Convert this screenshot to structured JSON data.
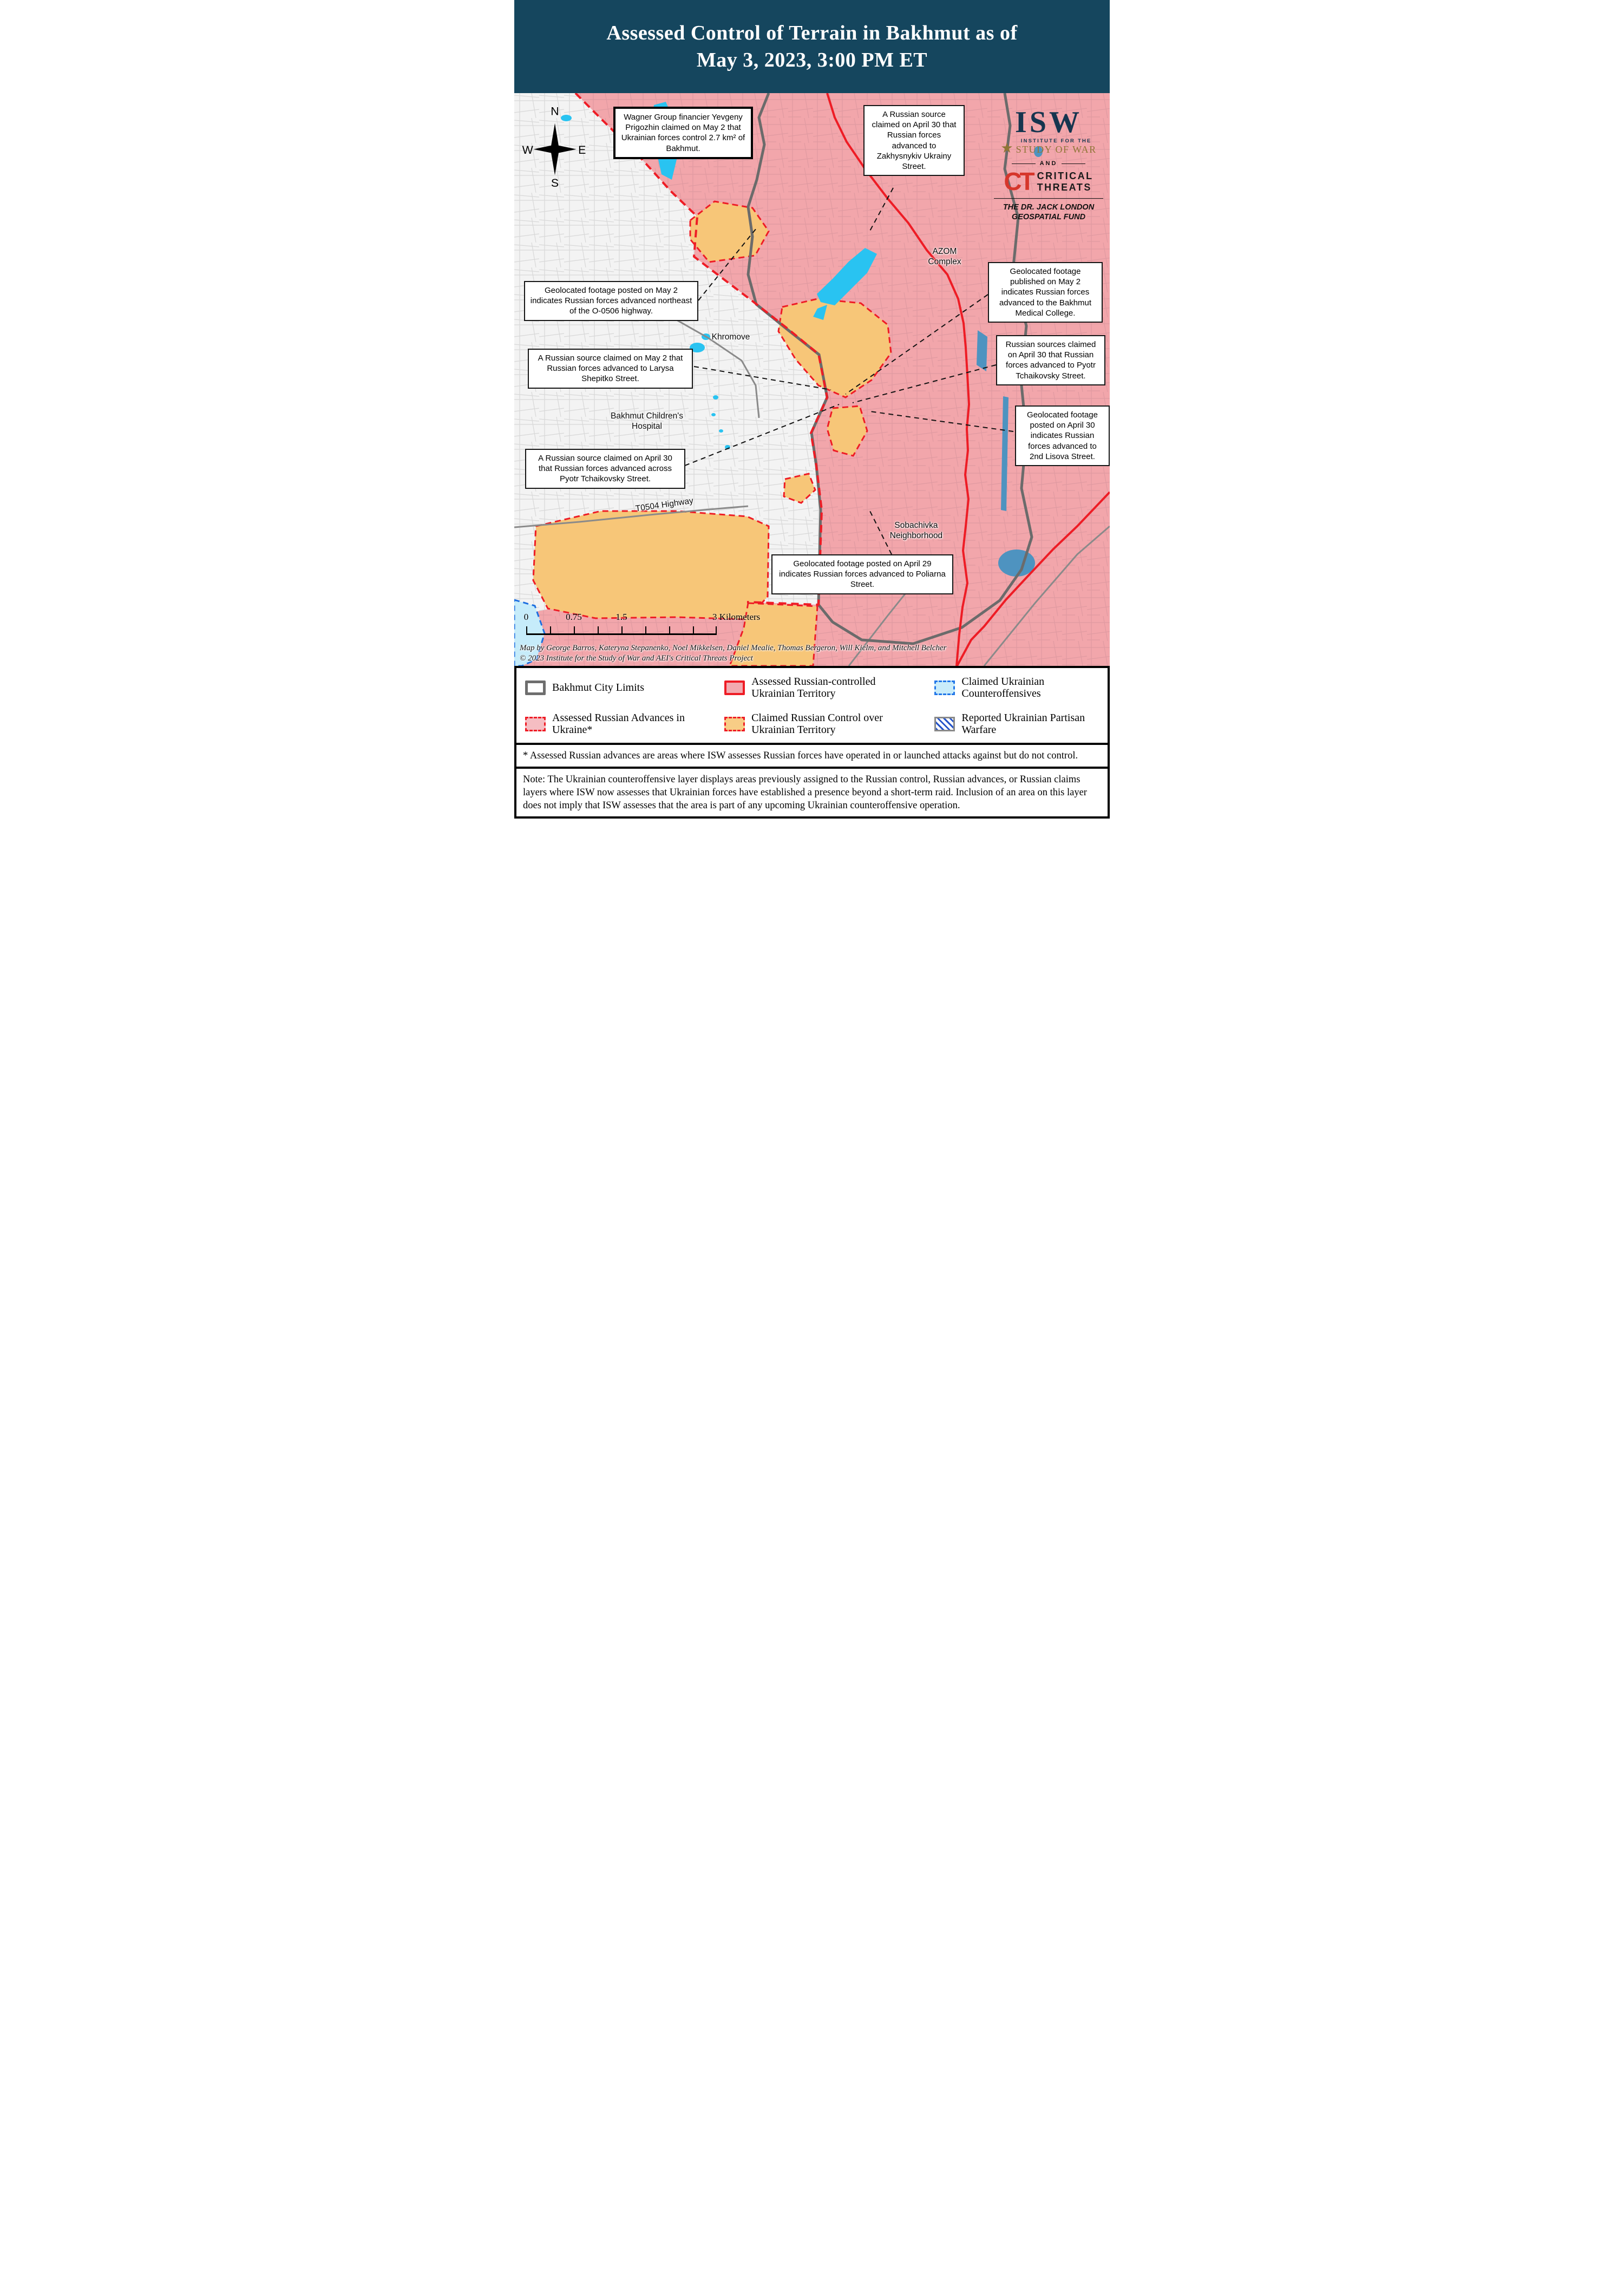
{
  "header": {
    "title_line1": "Assessed Control of Terrain in Bakhmut as of",
    "title_line2": "May 3, 2023, 3:00 PM ET"
  },
  "branding": {
    "isw_acronym": "ISW",
    "isw_line1": "INSTITUTE FOR THE",
    "isw_line2": "STUDY OF WAR",
    "and_label": "AND",
    "ct_acronym": "CT",
    "ct_line1": "CRITICAL",
    "ct_line2": "THREATS",
    "fund_line1": "THE DR. JACK LONDON",
    "fund_line2": "GEOSPATIAL FUND"
  },
  "compass": {
    "north": "N",
    "south": "S",
    "east": "E",
    "west": "W"
  },
  "map": {
    "labels": {
      "khromove": "Khromove",
      "azom_line1": "AZOM",
      "azom_line2": "Complex",
      "hospital_line1": "Bakhmut Children's",
      "hospital_line2": "Hospital",
      "sobachivka_line1": "Sobachivka",
      "sobachivka_line2": "Neighborhood",
      "highway": "T0504 Highway"
    },
    "callouts": [
      {
        "id": "wagner",
        "text": "Wagner Group financier Yevgeny Prigozhin claimed on May 2 that Ukrainian forces control 2.7 km² of Bakhmut."
      },
      {
        "id": "zakhysnykiv",
        "text": "A Russian source claimed on April 30 that Russian forces advanced to Zakhysnykiv Ukrainy Street."
      },
      {
        "id": "o0506",
        "text": "Geolocated footage posted on May 2 indicates Russian forces advanced northeast of the O-0506 highway."
      },
      {
        "id": "larysa-shepitko",
        "text": "A Russian source claimed on May 2 that Russian forces advanced to Larysa Shepitko Street."
      },
      {
        "id": "pyotr-across",
        "text": "A Russian source claimed on April 30 that Russian forces advanced across Pyotr Tchaikovsky Street."
      },
      {
        "id": "medical-college",
        "text": "Geolocated footage published on May 2 indicates Russian forces advanced to the Bakhmut Medical College."
      },
      {
        "id": "pyotr-sources",
        "text": "Russian sources claimed on April 30 that Russian forces advanced to Pyotr Tchaikovsky Street."
      },
      {
        "id": "lisova",
        "text": "Geolocated footage posted on April 30 indicates Russian forces advanced to 2nd Lisova Street."
      },
      {
        "id": "poliarna",
        "text": "Geolocated footage posted on April 29 indicates Russian forces advanced to Poliarna Street."
      }
    ],
    "scale_bar": {
      "t0": "0",
      "t1": "0.75",
      "t2": "1.5",
      "t3": "3 Kilometers"
    },
    "credits_line1": "Map by George Barros, Kateryna Stepanenko, Noel Mikkelsen, Daniel Mealie, Thomas Bergeron, Will Kielm, and Mitchell Belcher",
    "credits_line2": "© 2023 Institute for the Study of War and AEI's Critical Threats Project"
  },
  "legend": {
    "items": [
      {
        "label": "Bakhmut City Limits",
        "swatch": "city-limits"
      },
      {
        "label": "Assessed Russian Advances in Ukraine*",
        "swatch": "russian-advances"
      },
      {
        "label": "Assessed Russian-controlled Ukrainian Territory",
        "swatch": "russian-controlled"
      },
      {
        "label": "Claimed Russian Control over Ukrainian Territory",
        "swatch": "claimed-russian-control"
      },
      {
        "label": "Claimed Ukrainian Counteroffensives",
        "swatch": "ukrainian-counteroffensives"
      },
      {
        "label": "Reported Ukrainian Partisan Warfare",
        "swatch": "ukrainian-partisan-warfare"
      }
    ]
  },
  "footnote": "* Assessed Russian advances are areas where ISW assesses Russian forces have operated in or launched attacks against but do not control.",
  "note": "Note: The Ukrainian counteroffensive layer displays areas previously assigned to the Russian control, Russian advances, or Russian claims layers where ISW now assesses that Ukrainian forces have established a presence beyond a short-term raid. Inclusion of an area on this layer does not imply that ISW assesses that the area is part of any upcoming Ukrainian counteroffensive operation.",
  "colors": {
    "header_navy": "#15465E",
    "russian_controlled_pink": "#F2A6AB",
    "claimed_russian_orange": "#F7C678",
    "water_cyan": "#29C3F1",
    "water_steel_blue": "#4E93C0",
    "control_line_red": "#EE1C25",
    "city_limits_gray": "#6B6B6B",
    "isw_navy": "#16354F",
    "isw_gold": "#8F7536",
    "ct_red": "#D6362B",
    "counteroffensive_blue": "#1D6FE0"
  }
}
